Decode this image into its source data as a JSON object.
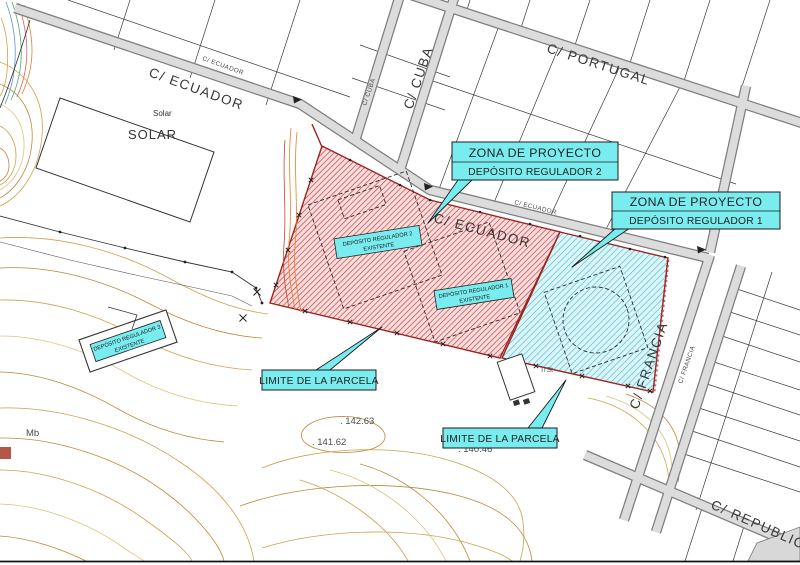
{
  "drawing": {
    "streets": {
      "ecuador": "C/ ECUADOR",
      "ecuador_small": "C/ ECUADOR",
      "ecuador_left": "C/ ECUADOR",
      "ecuador_left_small": "C/ ECUADOR",
      "cuba": "C/ CUBA",
      "cuba_small": "C/ CUBA",
      "portugal": "C/ PORTUGAL",
      "francia": "C/ FRANCIA",
      "francia_small": "C/ FRANCIA",
      "republic": "C/ REPUBLIC"
    },
    "callouts": {
      "zona2_line1": "ZONA DE PROYECTO",
      "zona2_line2": "DEPÓSITO REGULADOR 2",
      "zona1_line1": "ZONA DE PROYECTO",
      "zona1_line2": "DEPÓSITO REGULADOR 1",
      "limite_parcela_1": "LIMITE DE LA PARCELA",
      "limite_parcela_2": "LIMITE DE LA PARCELA",
      "dep2_line1": "DEPÓSITO REGULADOR 2",
      "dep2_line2": "EXISTENTE",
      "dep1_line1": "DEPÓSITO REGULADOR 1",
      "dep1_line2": "EXISTENTE",
      "dep3_line1": "DEPÓSITO REGULADOR 3",
      "dep3_line2": "EXISTENTE"
    },
    "labels": {
      "solar_small": "Solar",
      "solar_large": "SOLAR",
      "elevation_1": ". 142.63",
      "elevation_2": ". 141.62",
      "elevation_3": ". 140.46",
      "mb": "Mb",
      "trst": "TrSt"
    },
    "colors": {
      "project_zone_2_hatch": "#cc3434",
      "project_zone_1_hatch": "#35bccd",
      "callout_fill": "#79ecef",
      "parcel_boundary": "#9b2422",
      "road_fill": "#dcdcdc",
      "contour_tan": "#c9a24f"
    }
  }
}
